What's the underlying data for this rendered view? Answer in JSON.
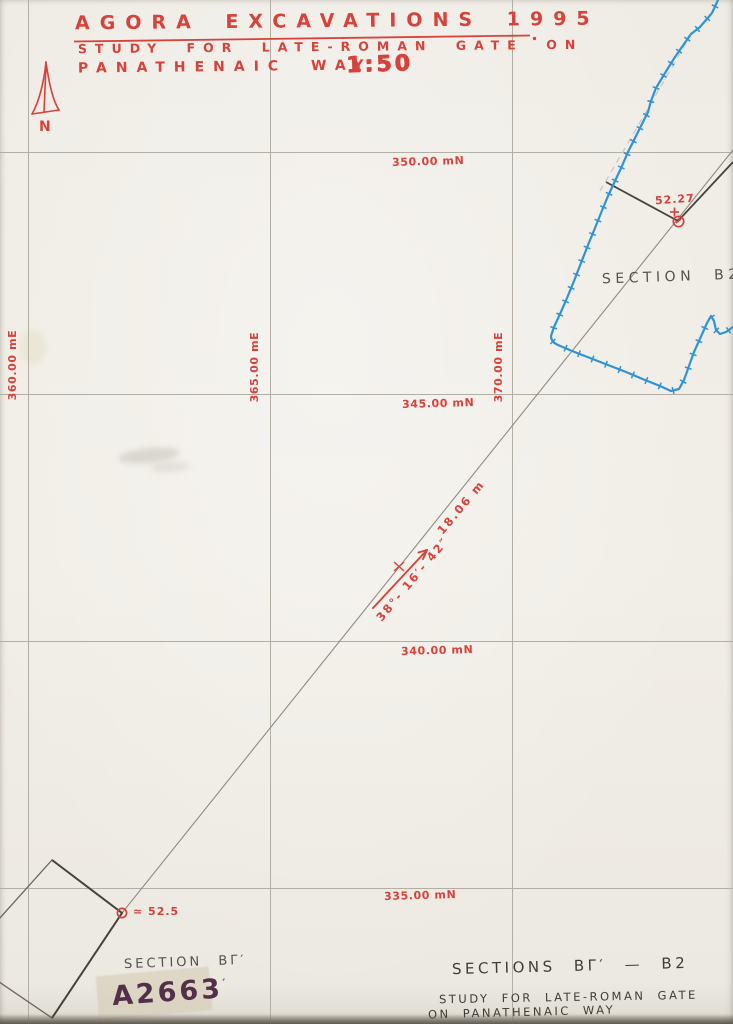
{
  "colors": {
    "red_ink": "#d8423c",
    "pencil_gray": "#55524b",
    "blue_ink": "#2f93d6",
    "marker_ink": "#53304a",
    "paper": "#f0ede6"
  },
  "header": {
    "title": "AGORA EXCAVATIONS 1995",
    "subtitle": "STUDY FOR LATE-ROMAN GATE ON",
    "subtitle2": "PANATHENAIC WAY",
    "scale": "1:50"
  },
  "compass": {
    "label": "N"
  },
  "grid": {
    "north_labels": [
      "350.00 mN",
      "345.00 mN",
      "340.00 mN",
      "335.00 mN"
    ],
    "east_labels": [
      "360.00 mE",
      "365.00 mE",
      "370.00 mE"
    ]
  },
  "annotations": {
    "elevation_b2": "52.27",
    "elevation_bg": "≃ 52.5",
    "distance": "18.06 m",
    "bearing": "38°- 16′- 42″",
    "section_b2": "SECTION B2",
    "section_bg": "SECTION BΓ′"
  },
  "footer": {
    "catalog_number": "A2663",
    "catalog_tick": "′",
    "sections_title": "SECTIONS BΓ′ — B2",
    "note_line1": "STUDY FOR LATE-ROMAN GATE",
    "note_line2": "ON PANATHENAIC WAY"
  }
}
